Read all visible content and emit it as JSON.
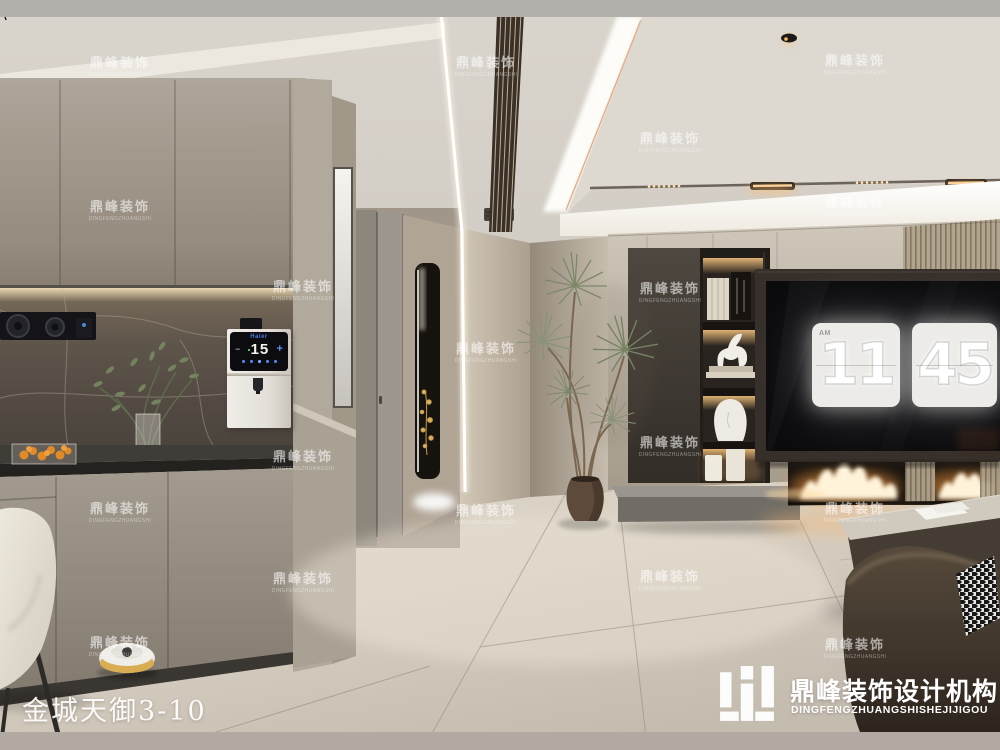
{
  "title": {
    "text": "金城天御3-10"
  },
  "logo": {
    "cn": "鼎峰装饰设计机构",
    "en": "DINGFENGZHUANGSHISHEJIJIGOU"
  },
  "watermark": {
    "cn": "鼎峰装饰",
    "en": "DINGFENGZHUANGSHI",
    "positions": [
      [
        120,
        52
      ],
      [
        486,
        52
      ],
      [
        855,
        50
      ],
      [
        670,
        128
      ],
      [
        120,
        196
      ],
      [
        855,
        192
      ],
      [
        303,
        276
      ],
      [
        670,
        278
      ],
      [
        486,
        338
      ],
      [
        670,
        432
      ],
      [
        303,
        446
      ],
      [
        120,
        498
      ],
      [
        486,
        500
      ],
      [
        855,
        498
      ],
      [
        303,
        568
      ],
      [
        670,
        566
      ],
      [
        120,
        632
      ],
      [
        855,
        634
      ]
    ]
  },
  "tv_clock": {
    "meridiem": "AM",
    "hours": "11",
    "minutes": "45"
  },
  "water_dispenser": {
    "brand": "Haier",
    "temperature": "15",
    "minus_label": "−",
    "plus_label": "+"
  },
  "colors": {
    "flame_orange": "#ff9e3e",
    "warm_light": "#f3c27f",
    "haier_blue": "#4a79d8",
    "watermark_white": "rgba(255,255,255,0.58)",
    "letterbox_top": "#b3afab",
    "letterbox_bottom": "#b2a9a2"
  }
}
